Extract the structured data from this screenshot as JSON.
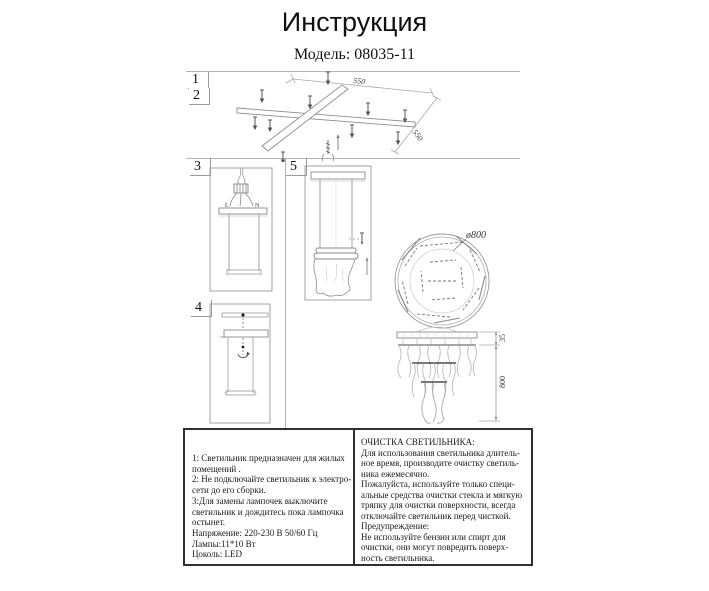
{
  "header": {
    "title": "Инструкция",
    "model": "Модель: 08035-11"
  },
  "steps": {
    "one": "1",
    "two": "2",
    "three": "3",
    "four": "4",
    "five": "5"
  },
  "labels": {
    "bracket_width": "550",
    "bracket_depth": "550",
    "wire_l": "L",
    "wire_n": "N",
    "diameter": "ø800",
    "canopy_gap": "35",
    "drop_height": "800"
  },
  "notes": {
    "lines": [
      "1: Светильник предназначен для жилых",
      "помещений .",
      "2: Не подключайте светильник к электро-",
      "сети до его сборки.",
      "3:Для замены лампочек выключите",
      "светильник  и дождитесь пока лампочка",
      "остынет.",
      "Напряжение: 220-230 В 50/60 Гц",
      "Лампы:11*10 Вт",
      "Цоколь: LED"
    ]
  },
  "care": {
    "lines": [
      "ОЧИСТКА СВЕТИЛЬНИКА:",
      "Для использования светильника длитель-",
      "ное время, производите очистку светиль-",
      "ника ежемесячно.",
      "Пожалуйста, используйте только специ-",
      "альные средства очистки стекла и мягкую",
      "тряпку для очистки поверхности, всегда",
      "отключайте светильник перед чисткой.",
      "Предупреждение:",
      "Не используйте бензин или спирт для",
      "очистки, они могут повредить поверх-",
      "ность светильника."
    ]
  }
}
